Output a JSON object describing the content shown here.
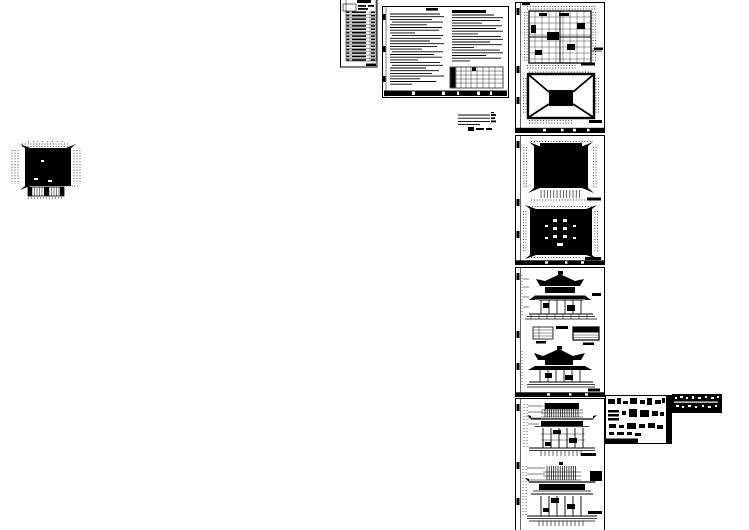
{
  "canvas": {
    "width": 749,
    "height": 530,
    "background": "#ffffff",
    "ink": "#000000"
  },
  "sheets": [
    {
      "key": "index",
      "title": "drawing index table sheet",
      "x": 340,
      "y": -3,
      "w": 38,
      "h": 74
    },
    {
      "key": "notes",
      "title": "general design notes sheet",
      "x": 382,
      "y": 6,
      "w": 127,
      "h": 92
    },
    {
      "key": "plans",
      "title": "floor plan and roof framing plan sheet",
      "x": 515,
      "y": 2,
      "w": 90,
      "h": 131
    },
    {
      "key": "roofplans",
      "title": "roof plans sheet",
      "x": 515,
      "y": 135,
      "w": 90,
      "h": 130
    },
    {
      "key": "elevations",
      "title": "building elevations sheet",
      "x": 515,
      "y": 267,
      "w": 90,
      "h": 130
    },
    {
      "key": "sections",
      "title": "building sections sheet",
      "x": 515,
      "y": 398,
      "w": 90,
      "h": 132
    },
    {
      "key": "detachedPlan",
      "title": "detached floor plan drawing",
      "x": 8,
      "y": 140,
      "w": 80,
      "h": 60
    },
    {
      "key": "legend",
      "title": "small legend and scale block",
      "x": 456,
      "y": 112,
      "w": 44,
      "h": 22
    },
    {
      "key": "details",
      "title": "construction details sheet",
      "x": 605,
      "y": 395,
      "w": 68,
      "h": 49
    },
    {
      "key": "textBlock",
      "title": "dense annotation text block",
      "x": 672,
      "y": 394,
      "w": 50,
      "h": 19
    }
  ]
}
